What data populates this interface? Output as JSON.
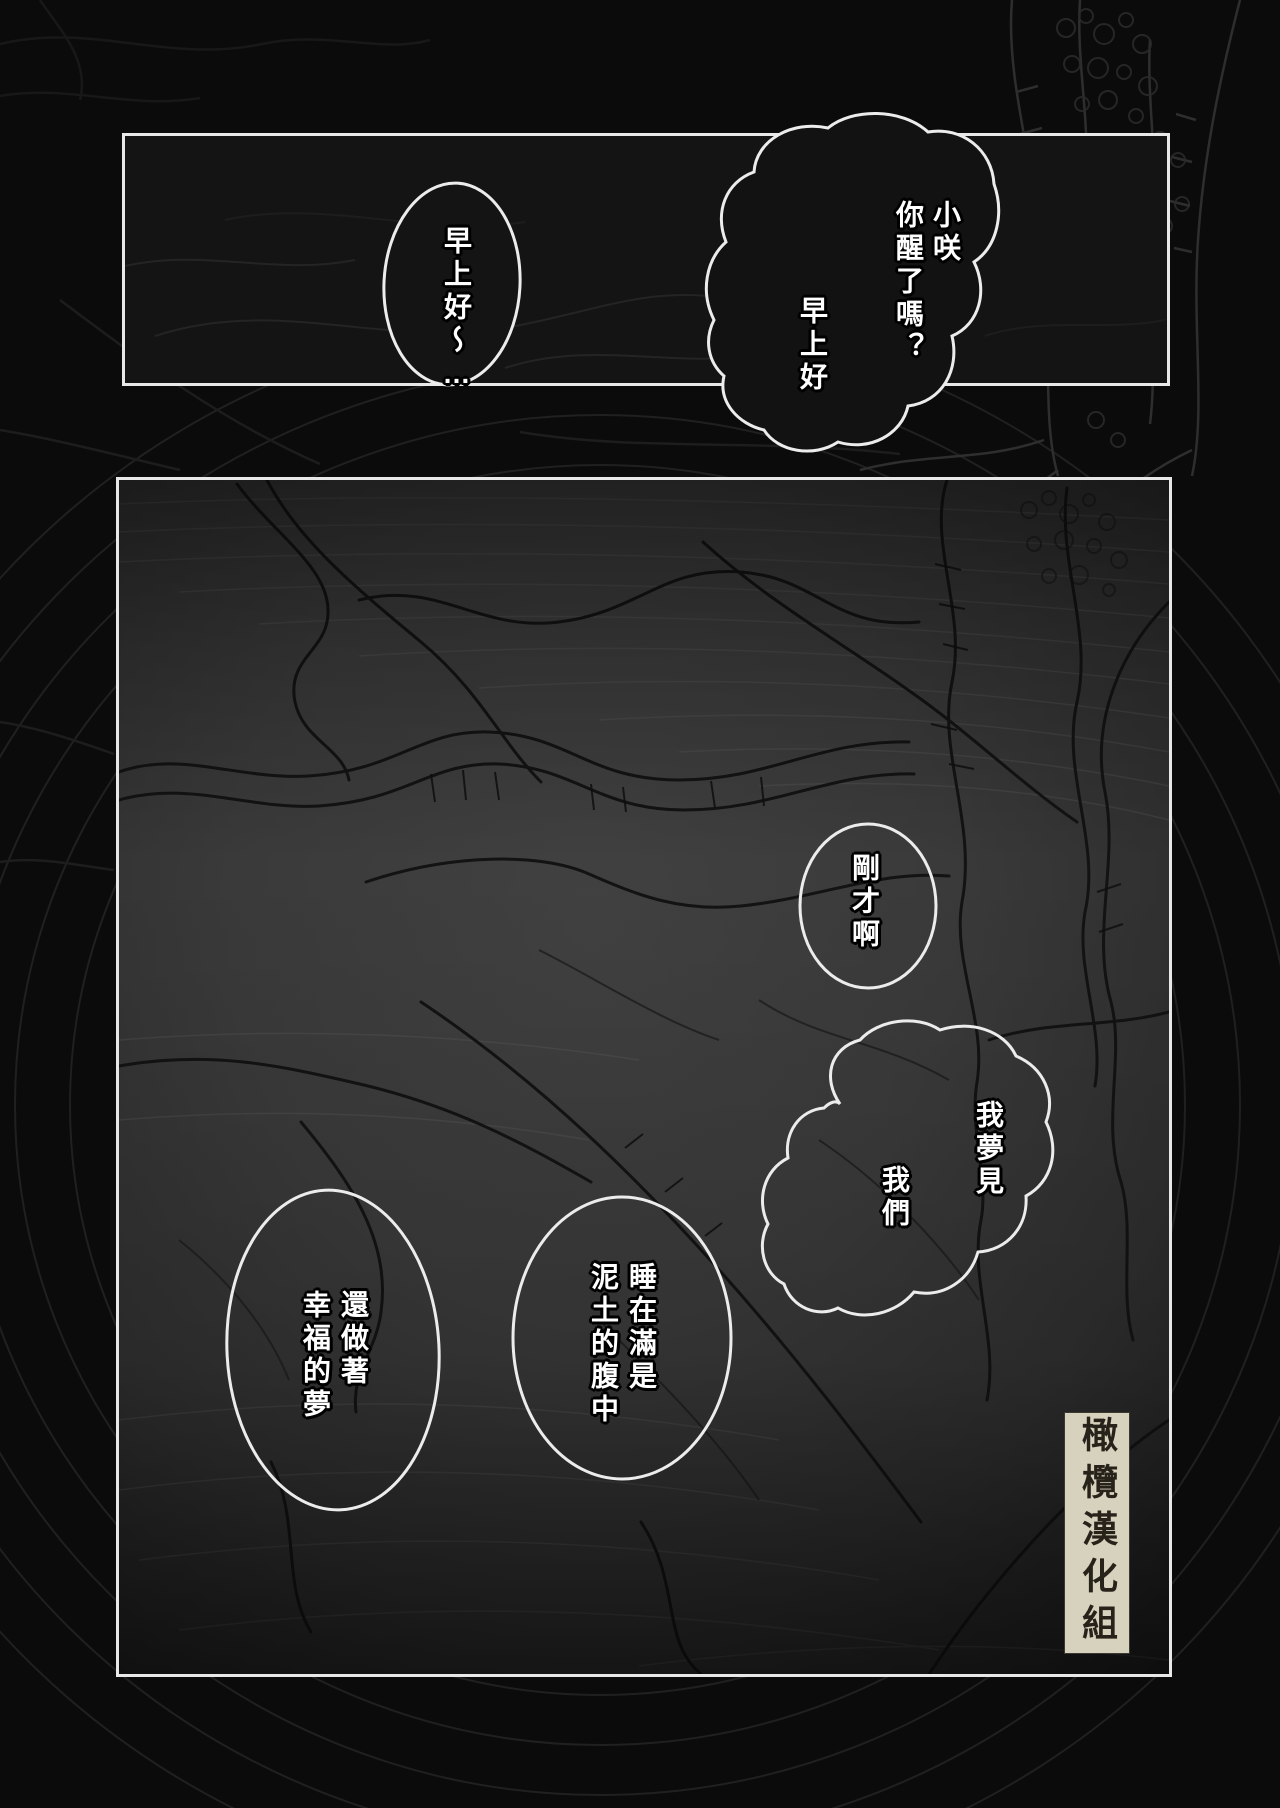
{
  "comic": {
    "bubbles": [
      {
        "name": "bubble-morning-reply",
        "lines": [
          "早上好～…"
        ]
      },
      {
        "name": "bubble-wake-up-call",
        "lines": [
          "小咲",
          "你醒了嗎？",
          "早上好"
        ]
      },
      {
        "name": "bubble-just-now",
        "lines": [
          "剛才啊"
        ]
      },
      {
        "name": "bubble-i-dreamt",
        "lines": [
          "我夢見",
          "我們"
        ]
      },
      {
        "name": "bubble-sleeping-in-soil",
        "lines": [
          "睡在滿是",
          "泥土的腹中"
        ]
      },
      {
        "name": "bubble-happy-dream",
        "lines": [
          "還做著",
          "幸福的夢"
        ]
      }
    ],
    "credit": {
      "group_label": "橄欖漢化組"
    },
    "colors": {
      "page_bg": "#0b0b0b",
      "panel_bg_dark": "#141414",
      "panel_bg_gray": "#3a3a3a",
      "panel_border": "#e8e8e8",
      "bubble_outline": "#efefef",
      "speech_text": "#ffffff",
      "speech_text_outline": "#000000",
      "credit_bg": "#d7d2be",
      "credit_text": "#27231a"
    }
  }
}
